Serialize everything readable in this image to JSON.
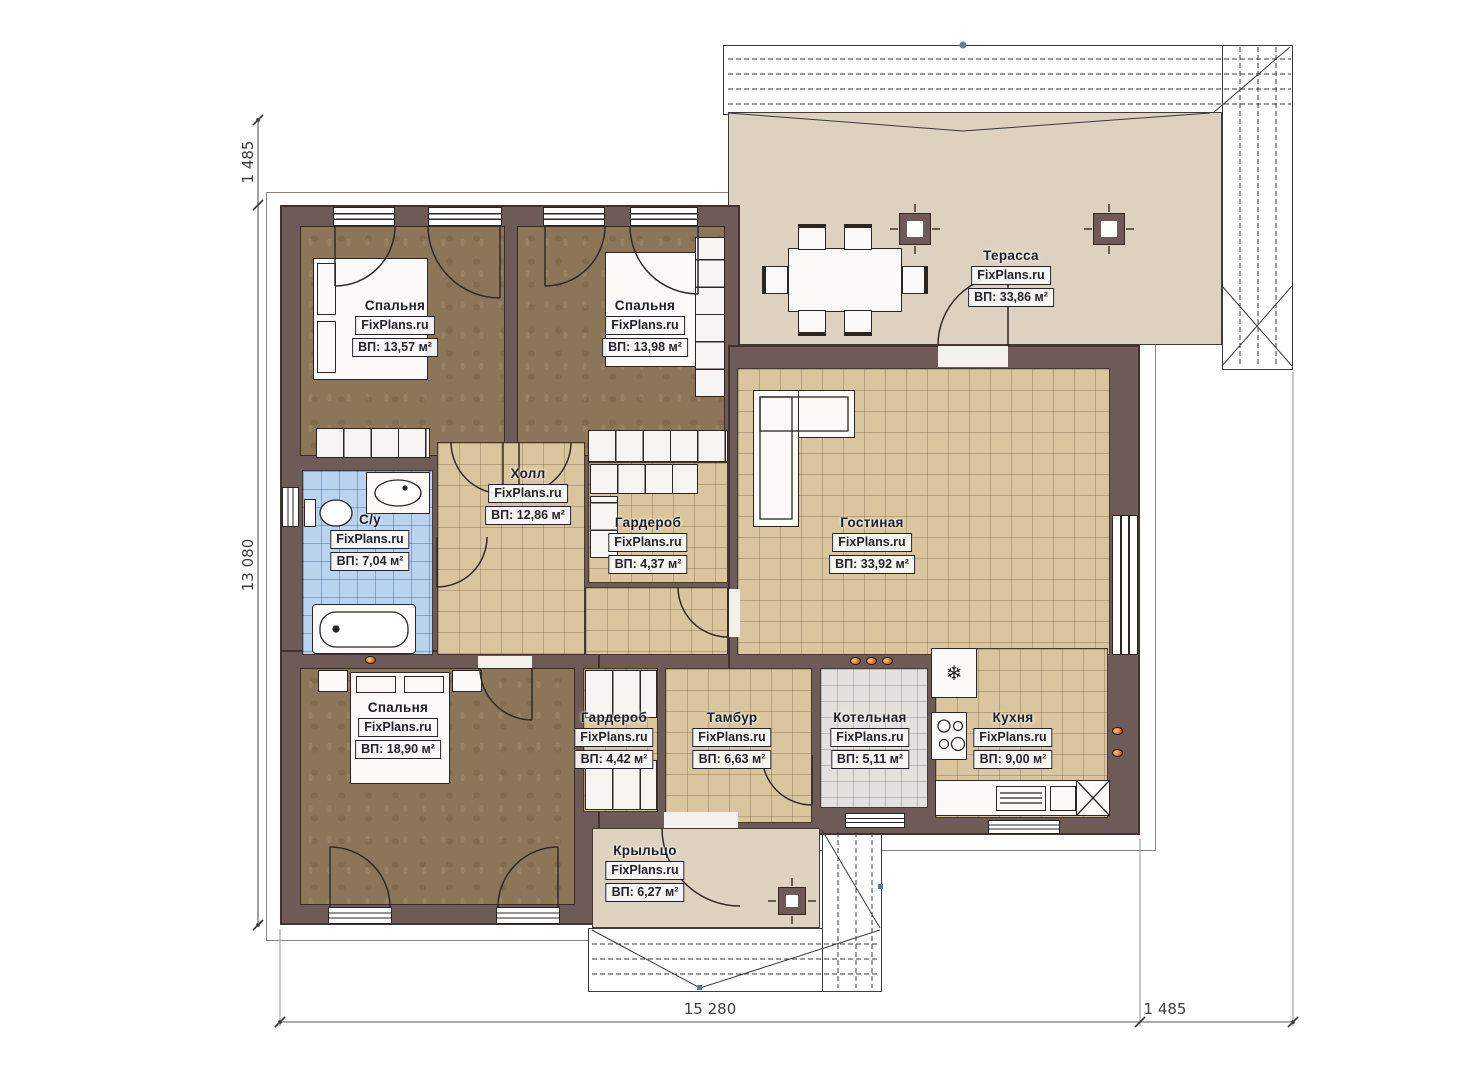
{
  "brand": "FixPlans.ru",
  "rooms": {
    "bedroom_tl": {
      "name": "Спальня",
      "brand": "FixPlans.ru",
      "area": "ВП: 13,57 м²"
    },
    "bedroom_tr": {
      "name": "Спальня",
      "brand": "FixPlans.ru",
      "area": "ВП: 13,98 м²"
    },
    "terrace": {
      "name": "Терасса",
      "brand": "FixPlans.ru",
      "area": "ВП: 33,86 м²"
    },
    "hall": {
      "name": "Холл",
      "brand": "FixPlans.ru",
      "area": "ВП: 12,86 м²"
    },
    "wardrobe1": {
      "name": "Гардероб",
      "brand": "FixPlans.ru",
      "area": "ВП: 4,37 м²"
    },
    "bathroom": {
      "name": "С/у",
      "brand": "FixPlans.ru",
      "area": "ВП: 7,04 м²"
    },
    "living": {
      "name": "Гостиная",
      "brand": "FixPlans.ru",
      "area": "ВП: 33,92 м²"
    },
    "bedroom_bl": {
      "name": "Спальня",
      "brand": "FixPlans.ru",
      "area": "ВП: 18,90 м²"
    },
    "wardrobe2": {
      "name": "Гардероб",
      "brand": "FixPlans.ru",
      "area": "ВП: 4,42 м²"
    },
    "tambour": {
      "name": "Тамбур",
      "brand": "FixPlans.ru",
      "area": "ВП: 6,63 м²"
    },
    "boiler": {
      "name": "Котельная",
      "brand": "FixPlans.ru",
      "area": "ВП: 5,11 м²"
    },
    "kitchen": {
      "name": "Кухня",
      "brand": "FixPlans.ru",
      "area": "ВП: 9,00 м²"
    },
    "porch": {
      "name": "Крыльцо",
      "brand": "FixPlans.ru",
      "area": "ВП: 6,27 м²"
    }
  },
  "dimensions": {
    "top_left_vertical": "1 485",
    "left_vertical": "13 080",
    "bottom_width": "15 280",
    "bottom_right": "1 485"
  },
  "icons": {
    "freezer_symbol": "❄"
  },
  "colors": {
    "wall": "#6e5a56",
    "tile_beige": "#d9c69e",
    "tile_blue": "#bad4ef",
    "tile_gray": "#e3e1de",
    "floor_brown": "#8b765a",
    "terrace_floor": "#ddd2bf",
    "vent_orange": "#d9742f"
  }
}
